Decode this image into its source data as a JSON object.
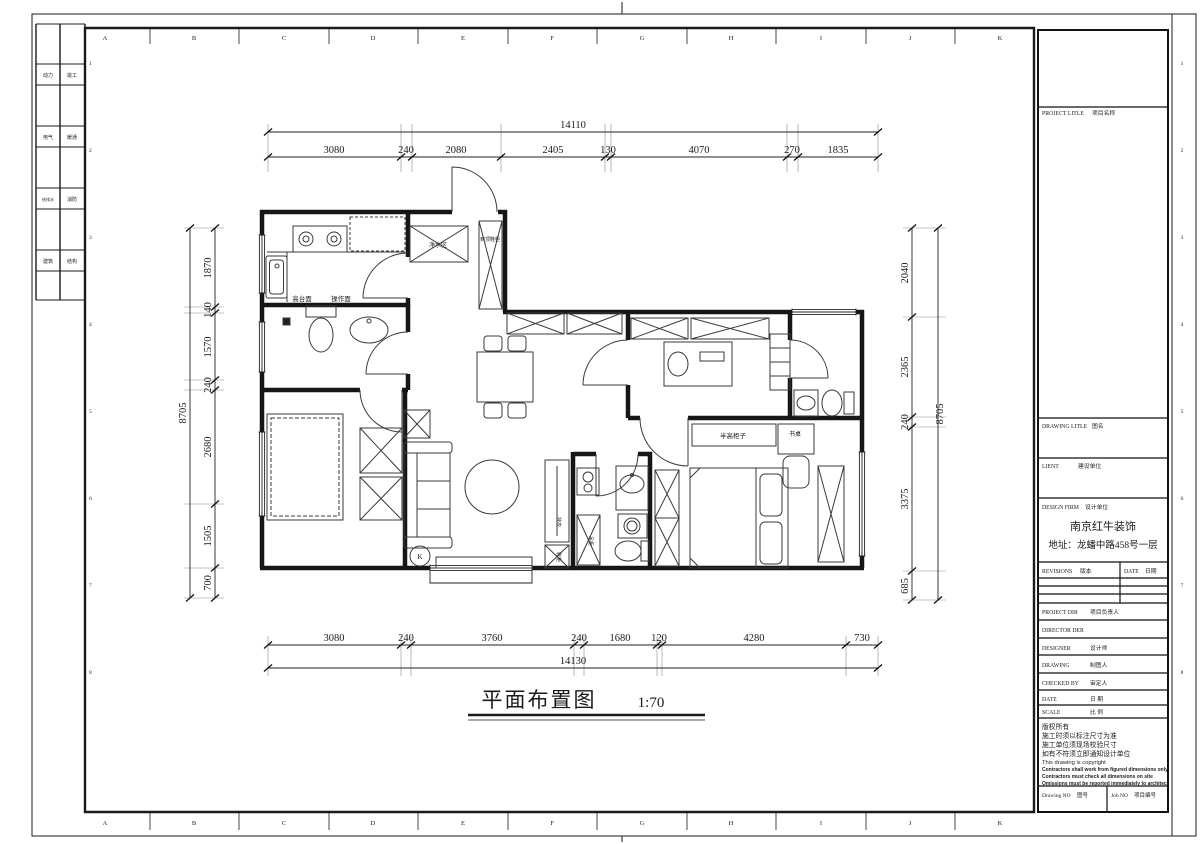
{
  "sheet": {
    "grid_letters": [
      "A",
      "B",
      "C",
      "D",
      "E",
      "F",
      "G",
      "H",
      "I",
      "J",
      "K"
    ],
    "row_numbers": [
      "1",
      "2",
      "3",
      "4",
      "5",
      "6",
      "7",
      "8"
    ],
    "signoff_labels": [
      [
        "动力",
        "竣工"
      ],
      [
        "电气",
        "暖通"
      ],
      [
        "给排水",
        "消防"
      ],
      [
        "建筑",
        "结构"
      ]
    ]
  },
  "drawing_title": {
    "text": "平面布置图",
    "scale": "1:70"
  },
  "dimensions": {
    "top": {
      "total": "14110",
      "segments": [
        "3080",
        "240",
        "2080",
        "2405",
        "130",
        "4070",
        "270",
        "1835"
      ]
    },
    "bottom": {
      "total": "14130",
      "segments": [
        "3080",
        "240",
        "3760",
        "240",
        "1680",
        "120",
        "4280",
        "730"
      ]
    },
    "left": {
      "total": "8705",
      "segments": [
        "1870",
        "140",
        "1570",
        "240",
        "2680",
        "1505",
        "700"
      ]
    },
    "right": {
      "total": "8705",
      "segments": [
        "2040",
        "2365",
        "240",
        "3375",
        "685"
      ]
    }
  },
  "plan_labels": {
    "counter_high": "高台面",
    "counter_work": "操作面",
    "water_area": "净水区",
    "entry_cabinet": "到顶鞋柜",
    "half_cabinet": "半高柜子",
    "desk": "书桌",
    "hanging": "挂衣",
    "shoe_cabinet": "鞋柜",
    "cabinet": "吊柜",
    "k_mark": "K"
  },
  "title_block": {
    "project_title": {
      "en": "PROJECT LITLE",
      "zh": "项目名称"
    },
    "drawing_title": {
      "en": "DRAWING LITLE",
      "zh": "图名"
    },
    "client": {
      "en": "LIENT",
      "zh": "建设单位"
    },
    "design_firm": {
      "en": "DESIGN FIRM",
      "zh": "设计单位",
      "name": "南京红牛装饰",
      "address": "地址：龙蟠中路458号一层"
    },
    "revisions": {
      "en": "REVISIONS",
      "zh": "版本"
    },
    "date_col": {
      "en": "DATE",
      "zh": "日期"
    },
    "project_dir": {
      "en": "PROJECT DIR",
      "zh": "项目负责人"
    },
    "director": {
      "en": "DIRECTOR DER"
    },
    "designer": {
      "en": "DESIGNER",
      "zh": "设计师"
    },
    "drawing_by": {
      "en": "DRAWING",
      "zh": "制图人"
    },
    "checked_by": {
      "en": "CHECKED BY",
      "zh": "审定人"
    },
    "date_row": {
      "en": "DATE",
      "zh": "日 期"
    },
    "scale_row": {
      "en": "SCALE",
      "zh": "比 例"
    },
    "notes": [
      "版权所有",
      "施工时须以标注尺寸为准",
      "施工单位须现场校验尺寸",
      "如有不符须立即通知设计单位",
      "This drawing is copyright"
    ],
    "notes_en": [
      "Contractors shall work from figured dimensions only",
      "Contractors must check all dimensions on site",
      "Omissions must be reported immediately to architect"
    ],
    "drawing_no": {
      "en": "Drawing NO",
      "zh": "图号"
    },
    "job_no": {
      "en": "Job NO",
      "zh": "项目编号"
    }
  }
}
